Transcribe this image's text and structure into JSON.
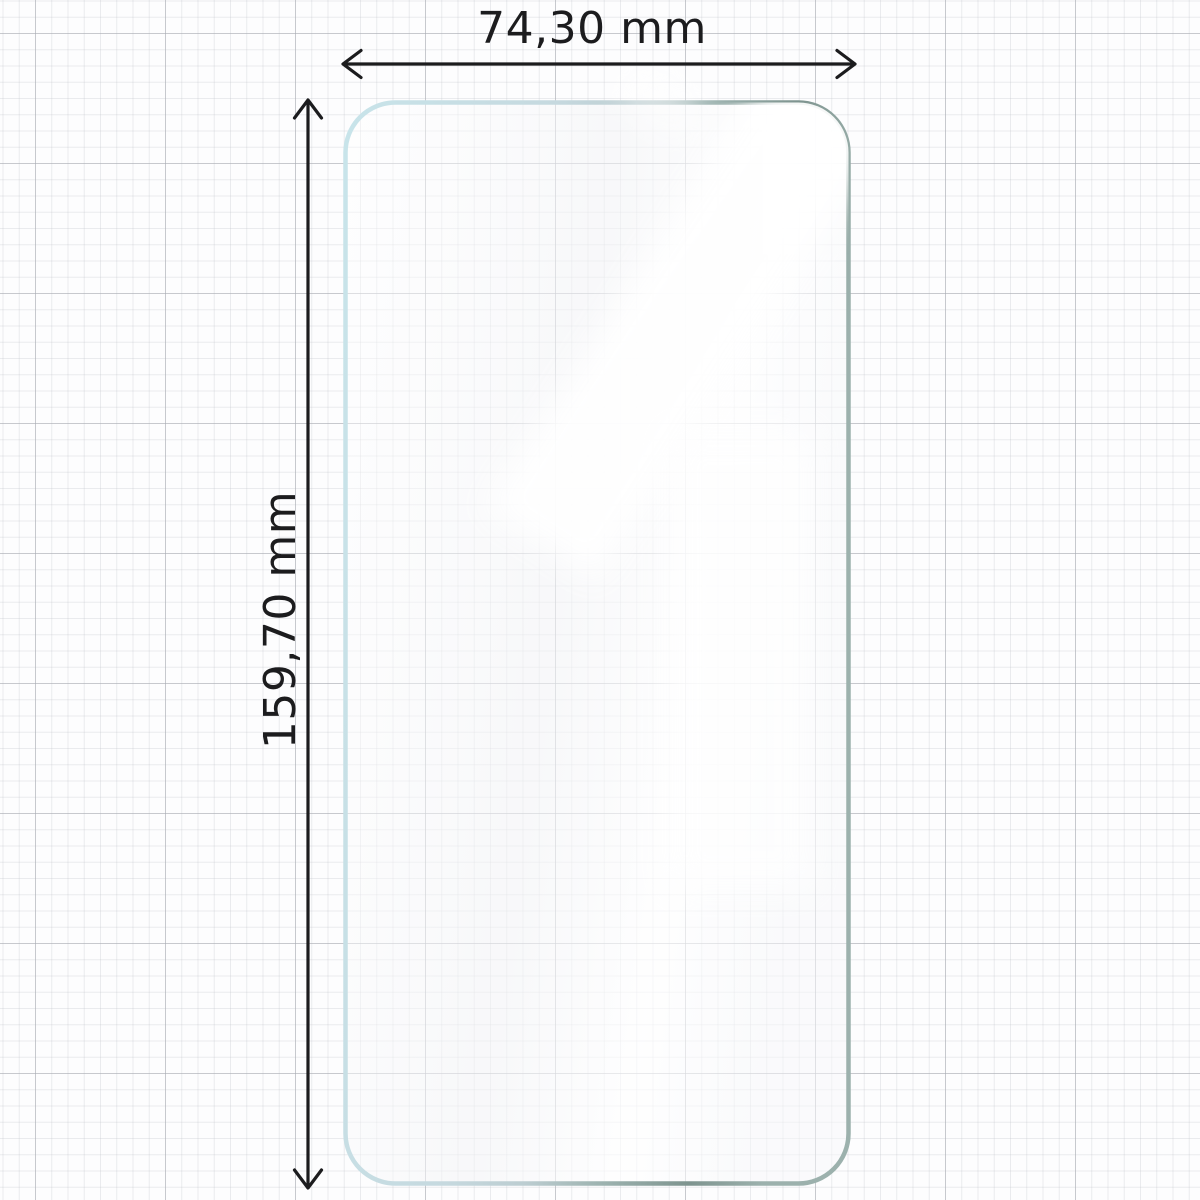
{
  "diagram": {
    "dimensions": {
      "width_label": "74,30 mm",
      "height_label": "159,70 mm"
    },
    "colors": {
      "dimension_line": "#1c1c1e",
      "film_edge_light": "#c8e4ea",
      "film_edge_mid": "#a0b6b2",
      "film_edge_dark": "#7e948f",
      "film_fill": "rgba(255,255,255,0.5)",
      "grid_minor": "#e8e9ec",
      "grid_major": "#c6c8cc",
      "background": "#fdfdfe"
    }
  }
}
